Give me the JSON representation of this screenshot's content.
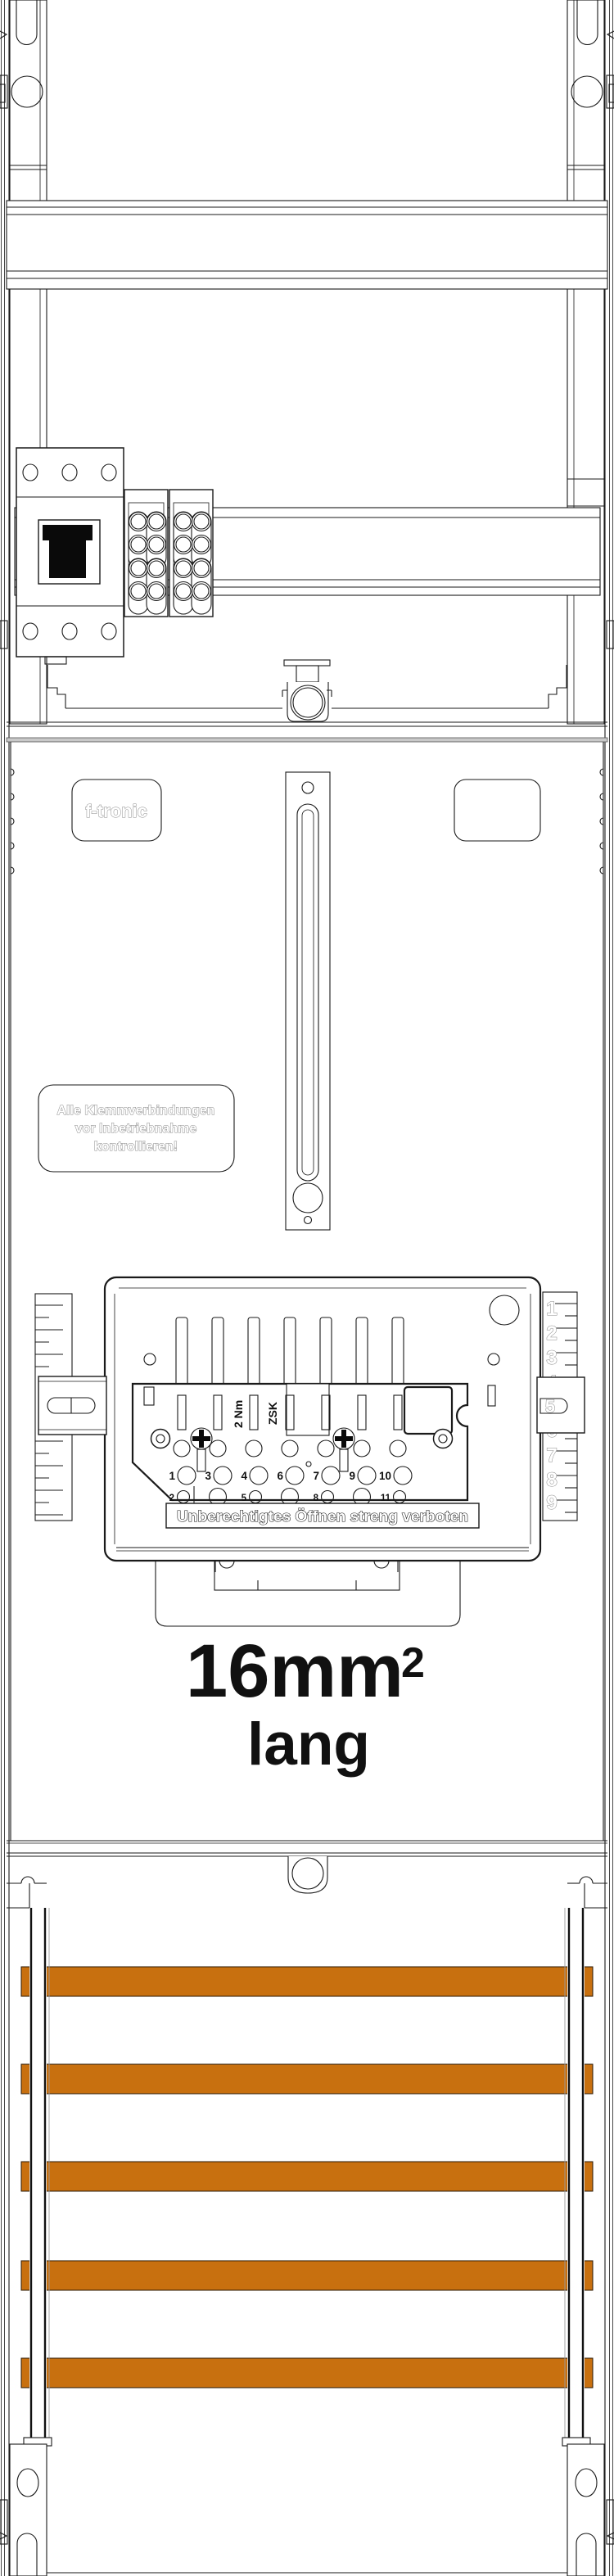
{
  "brand": {
    "logo": "f-tronic"
  },
  "warning_label": {
    "line1": "Alle Klemmverbindungen",
    "line2": "vor Inbetriebnahme",
    "line3": "kontrollieren!"
  },
  "zsk": {
    "model": "ZSK",
    "torque": "2 Nm",
    "seal_notice": "Unberechtigtes Öffnen streng verboten",
    "terminal_row1": [
      "1",
      "3",
      "4",
      "6",
      "7",
      "9",
      "10"
    ],
    "terminal_row2": [
      "2",
      "5",
      "8",
      "11"
    ],
    "scale": [
      "1",
      "2",
      "3",
      "4",
      "5",
      "6",
      "7",
      "8",
      "9"
    ],
    "bracket_number": "5"
  },
  "caption": {
    "size_main": "16mm",
    "size_sup": "2",
    "size_sub": "lang"
  },
  "busbars": {
    "count": 5,
    "y_positions": [
      2402,
      2521,
      2640,
      2761,
      2880
    ]
  },
  "colors": {
    "busbar": "#c8700f",
    "busbar_edge": "#2a1703",
    "line": "#1a1a1a"
  }
}
